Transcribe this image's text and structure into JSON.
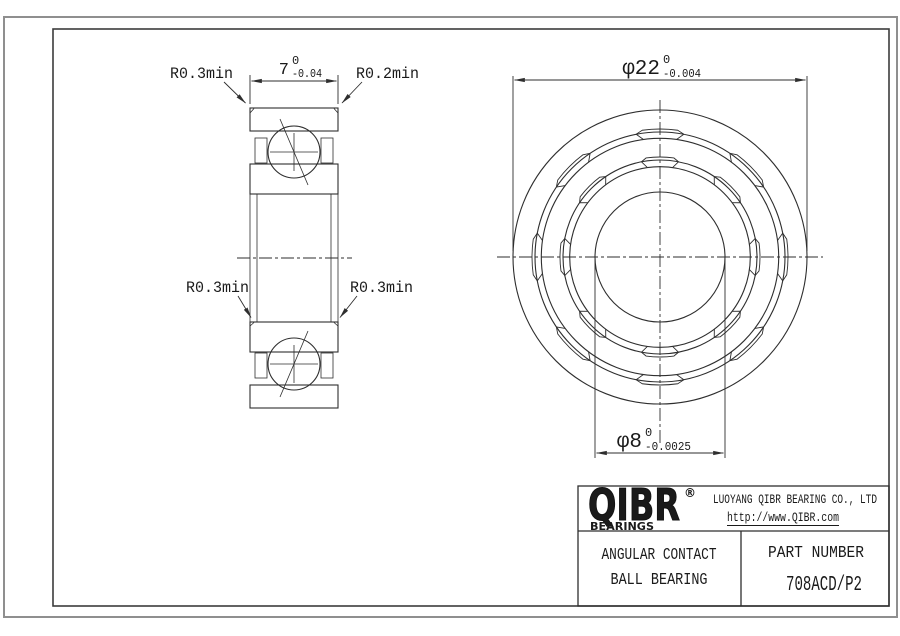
{
  "drawing": {
    "section_labels": {
      "top_left": "R0.3min",
      "top_right": "R0.2min",
      "mid_left": "R0.3min",
      "mid_right": "R0.3min"
    },
    "dim_width": {
      "nominal": "7",
      "upper": "0",
      "lower": "-0.04"
    },
    "dim_od": {
      "nominal": "φ22",
      "upper": "0",
      "lower": "-0.004"
    },
    "dim_bore": {
      "nominal": "φ8",
      "upper": "0",
      "lower": "-0.0025"
    }
  },
  "title_block": {
    "logo": {
      "name": "QIBR",
      "registered": "®",
      "tagline": "BEARINGS"
    },
    "company": "LUOYANG QIBR BEARING CO., LTD",
    "website": "http://www.QIBR.com",
    "product_type_line1": "ANGULAR CONTACT",
    "product_type_line2": "BALL BEARING",
    "part_number_label": "PART NUMBER",
    "part_number": "708ACD/P2"
  },
  "colors": {
    "line": "#2e2e2e",
    "text": "#1a1a1a",
    "frame": "#3c3c3c",
    "sheet_edge": "#8f8f8f",
    "background": "#ffffff"
  }
}
